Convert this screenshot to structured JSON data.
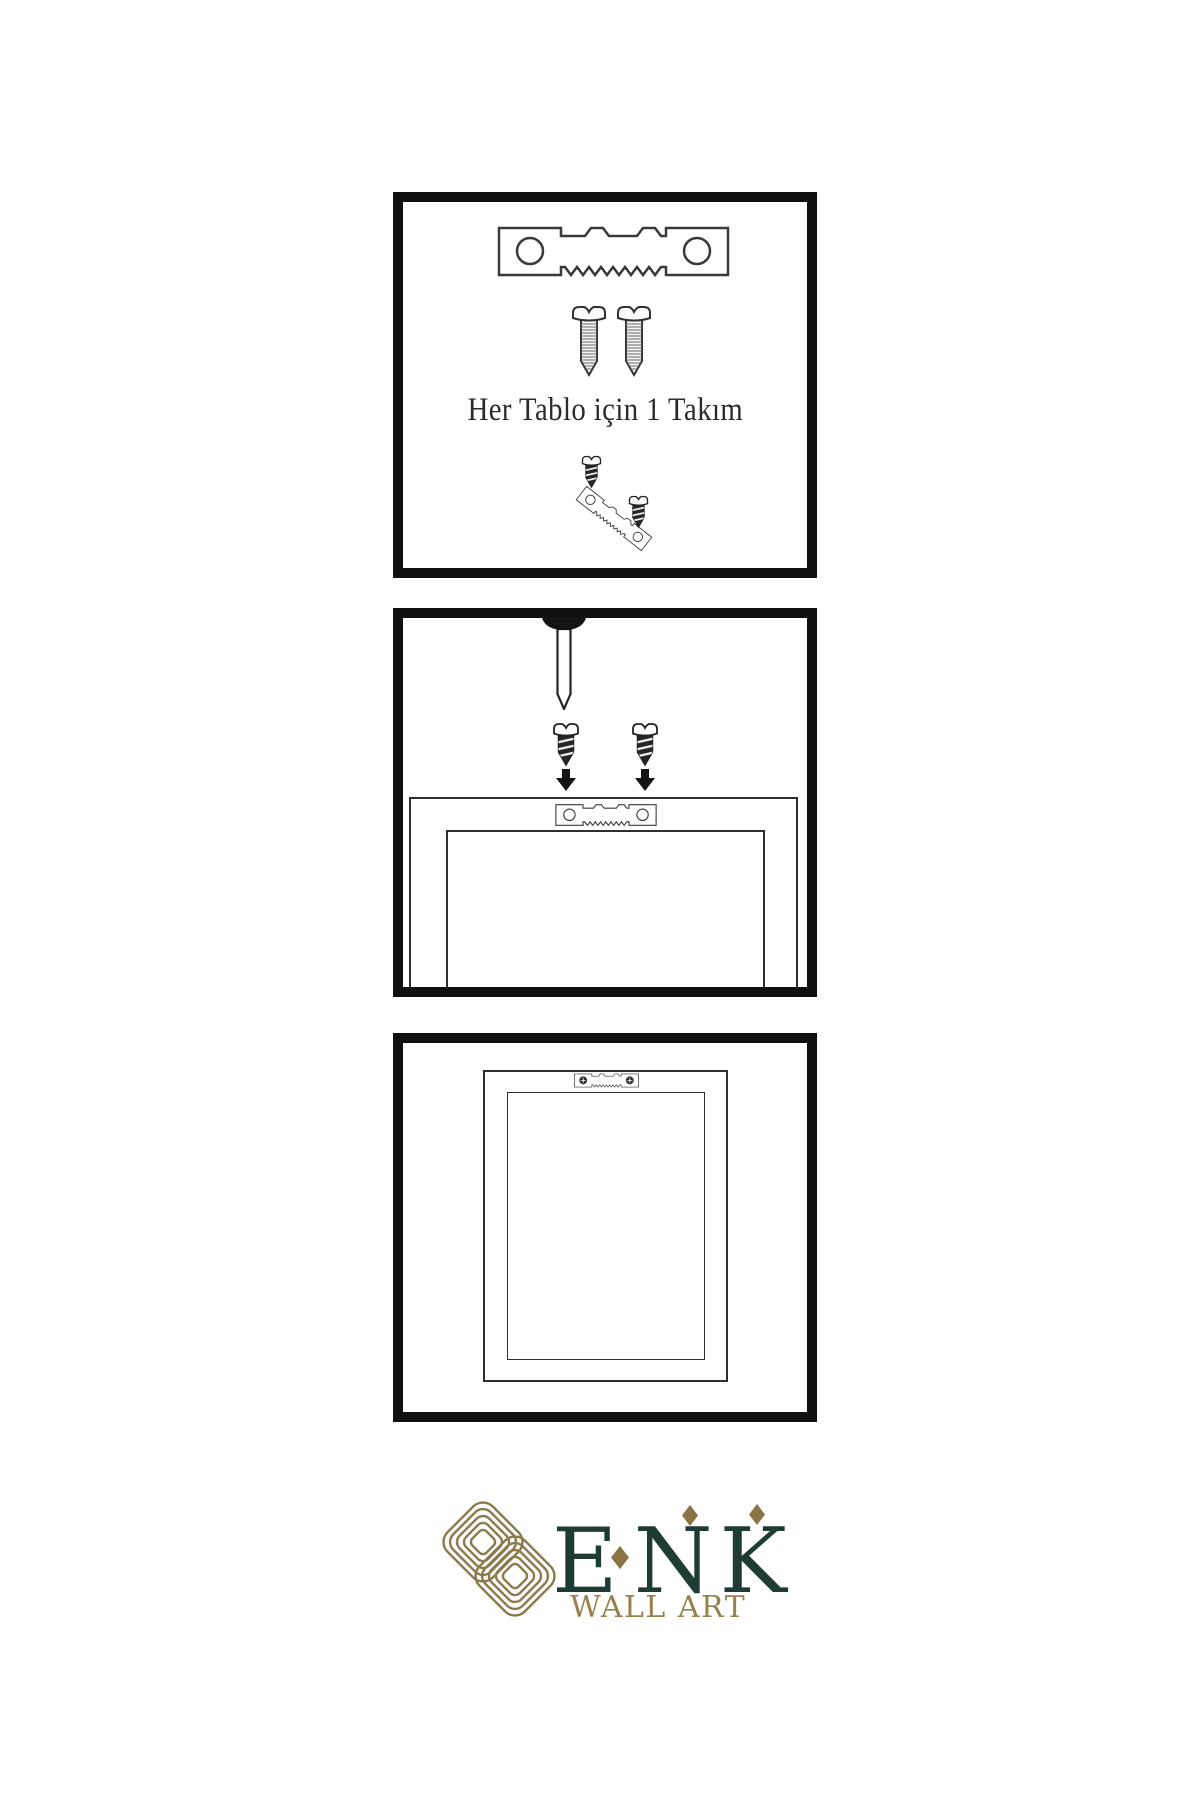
{
  "steps": {
    "step1": {
      "caption": "Her Tablo için 1 Takım",
      "icons": [
        "sawtooth-hanger-icon",
        "screw-icon",
        "screw-icon",
        "screw-into-hanger-assembly"
      ]
    },
    "step2": {
      "icons": [
        "wall-nail-icon",
        "screw-down-icon",
        "screw-down-icon",
        "down-arrow-icon",
        "frame-back-with-sawtooth-hanger"
      ]
    },
    "step3": {
      "icons": [
        "frame-back-mounted-sawtooth-hanger"
      ]
    }
  },
  "logo": {
    "brand": "ENK",
    "tagline": "WALL ART",
    "knot_icon": "interlocking-knot-icon"
  },
  "colors": {
    "panel_border": "#101010",
    "line": "#333333",
    "dark_fill": "#262626",
    "brand_green": "#1e3c33",
    "brand_gold": "#8c7a4c",
    "text": "#2b2b2b"
  }
}
